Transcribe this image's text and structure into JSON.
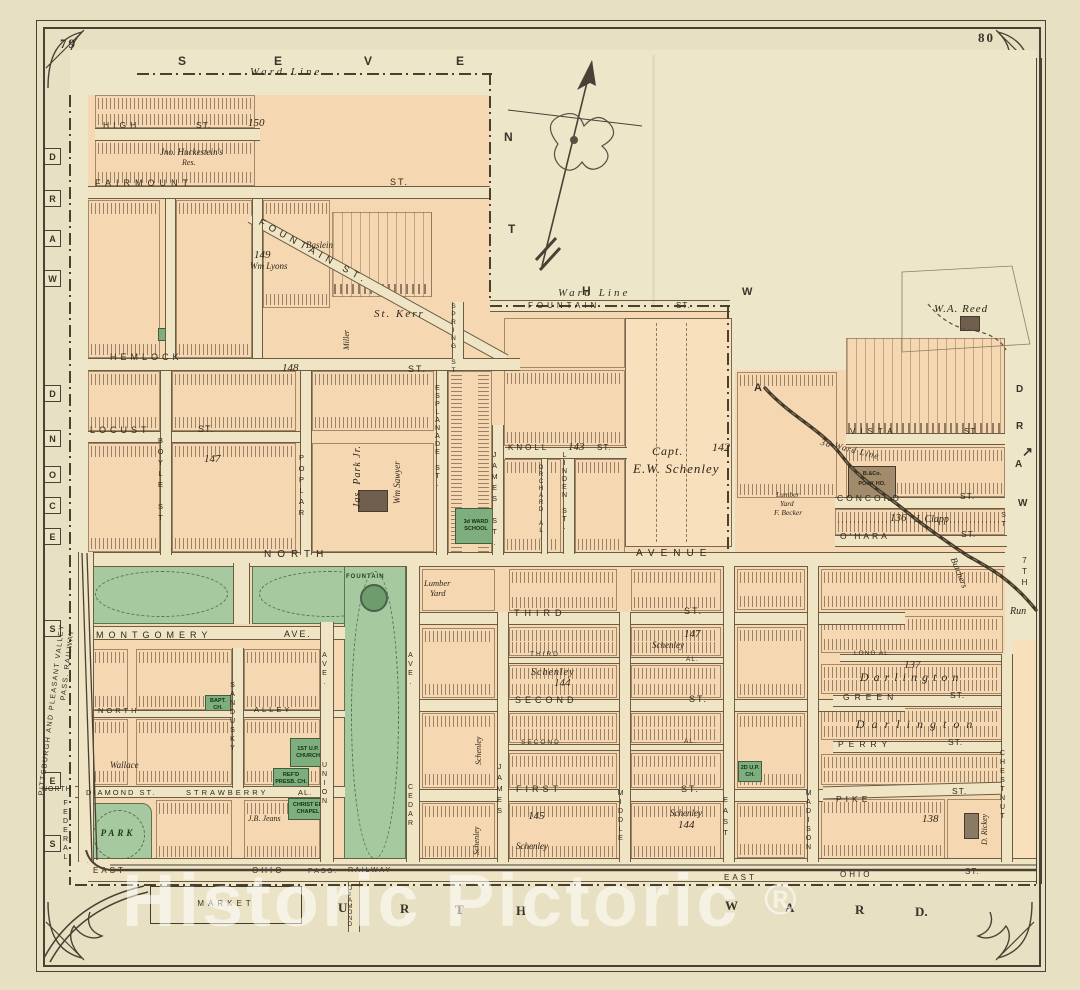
{
  "page": {
    "left_no": "79",
    "right_no": "80",
    "watermark": "Historic Pictoric",
    "registered": "®"
  },
  "title": {
    "main": "THIRD WARD.",
    "sub": "ALLEGHENY CITY.",
    "scale": "Scale 200 Feet per Inch."
  },
  "boundary": {
    "ward_line_top": "Ward Line",
    "ward_line_mid": "Ward Line",
    "ward_line_run": "3d Ward Line",
    "top_letters": [
      "S",
      "E",
      "V",
      "E",
      "N",
      "T",
      "H"
    ],
    "left_letters": [
      "D",
      "R",
      "A",
      "W",
      "D",
      "N",
      "O",
      "C",
      "E",
      "S",
      "E",
      "S"
    ],
    "bottom_letters": [
      "F",
      "O",
      "U",
      "R",
      "T",
      "H",
      "W",
      "A",
      "R",
      "D."
    ],
    "right_letters": [
      "D",
      "R",
      "A",
      "W"
    ],
    "ne_letters": [
      "W",
      "A"
    ],
    "seventh": "7TH.",
    "seventh_st": "ST",
    "arrow": "↗"
  },
  "streets": {
    "high": "HIGH",
    "high_st": "ST.",
    "fairmount": "FAIRMOUNT",
    "fairmount_st": "ST.",
    "fountain_diag": "FOUNTAIN ST.",
    "fountain_e": "FOUNTAIN",
    "fountain_e_st": "ST.",
    "hemlock": "HEMLOCK",
    "hemlock_st": "ST.",
    "locust": "LOCUST",
    "locust_st": "ST.",
    "boyle": "BOYLE ST",
    "poplar": "POPLAR",
    "spring": "SPRING ST",
    "esplanade": "ESPLANADE ST.",
    "james_n": "JAMES ST.",
    "orchard": "ORCHARD AL.",
    "linden": "LINDEN ST.",
    "knoll": "KNOLL",
    "knoll_st": "ST.",
    "north": "NORTH",
    "avenue": "AVENUE",
    "montgomery": "MONTGOMERY",
    "montgomery_ave": "AVE.",
    "north_alley_a": "NORTH",
    "north_alley_b": "ALLEY",
    "sandusky": "SANDUSKY",
    "union_ave": "AVE.",
    "union": "UNION",
    "cedar_ave": "AVE.",
    "cedar": "CEDAR",
    "third": "THIRD",
    "third_st": "ST.",
    "third_alley": "THIRD",
    "third_alley_suffix": "AL.",
    "second": "SECOND",
    "second_st": "ST.",
    "second_alley": "SECOND",
    "second_alley_suffix": "AL.",
    "first": "FIRST",
    "first_st": "ST.",
    "north_sm": "NORTH",
    "diamond": "DIAMOND ST.",
    "strawberry": "STRAWBERRY",
    "strawberry_al": "AL.",
    "federal": "FEDERAL",
    "east_a": "EAST",
    "ohio_a": "OHIO",
    "east_b": "EAST",
    "ohio_b": "OHIO",
    "ohio_b_st": "ST.",
    "concord": "CONCORD",
    "concord_st": "ST.",
    "ohara": "O'HARA",
    "ohara_st": "ST.",
    "green": "GREEN",
    "green_st": "ST.",
    "perry": "PERRY",
    "perry_st": "ST.",
    "pike": "PIKE",
    "pike_st": "ST.",
    "long_alley": "LONG AL.",
    "vista": "VISTA",
    "vista_st": "ST.",
    "james_s": "JAMES",
    "middle": "MIDDLE",
    "east_v": "EAST",
    "madison": "MADISON",
    "chestnut": "CHESTNUT",
    "diamond_v": "DIAMOND"
  },
  "railways": {
    "ppv_line1": "PITTSBURGH AND PLEASANT VALLEY",
    "ppv_line2": "PASS. RAILWAY",
    "ohio_pass": "PASS.",
    "ohio_railway": "RAILWAY"
  },
  "places": {
    "market": "MARKET",
    "park": "PARK",
    "fountain": "FOUNTAIN",
    "school_l1": "3d WARD",
    "school_l2": "SCHOOL",
    "baptist": "BAPT. CH.",
    "reformed_l1": "REF'D",
    "reformed_l2": "PRESB. CH.",
    "up_church_l1": "1ST U.P.",
    "up_church_l2": "CHURCH",
    "chapel_l1": "CHRIST EP.",
    "chapel_l2": "CHAPEL",
    "small_church": "2D U.P. CH.",
    "pork_l1": "B.&Co.",
    "pork_l2": "PORK HO.",
    "lumber_l1": "Lumber",
    "lumber_l2": "Yard",
    "becker_l1": "Lumber",
    "becker_l2": "Yard",
    "becker_l3": "F. Becker"
  },
  "owners": {
    "huckestein": "Jno. Huckestein's",
    "huckestein_res": "Res.",
    "lyons": "Wm Lyons",
    "baslein": "Baslein",
    "kerr": "St. Kerr",
    "miller": "Miller",
    "park_jr": "Jas. Park Jr.",
    "sawyer": "Wm Sawyer",
    "capt": "Capt.",
    "schenley_full": "E.W. Schenley",
    "reed": "W.A. Reed",
    "clapp": "J. Clapp",
    "wallace": "Wallace",
    "darlington_a": "Darlington",
    "darlington_b": "Darlington",
    "schenley_a": "Schenley",
    "schenley_b": "Schenley",
    "schenley_c": "Schenley",
    "schenley_d": "Schenley",
    "schenley_e": "Schenley",
    "schenley_f": "Schenley",
    "rickey": "D. Rickey",
    "jeans": "J.B. Jeans",
    "butchers": "Butchers",
    "run": "Run"
  },
  "numbers": {
    "n136": "136",
    "n137": "137",
    "n138": "138",
    "n142": "142",
    "n143": "143",
    "n144_a": "144",
    "n144_b": "144",
    "n145": "145",
    "n147_a": "147",
    "n147_b": "147",
    "n148": "148",
    "n149": "149",
    "n150": "150"
  }
}
